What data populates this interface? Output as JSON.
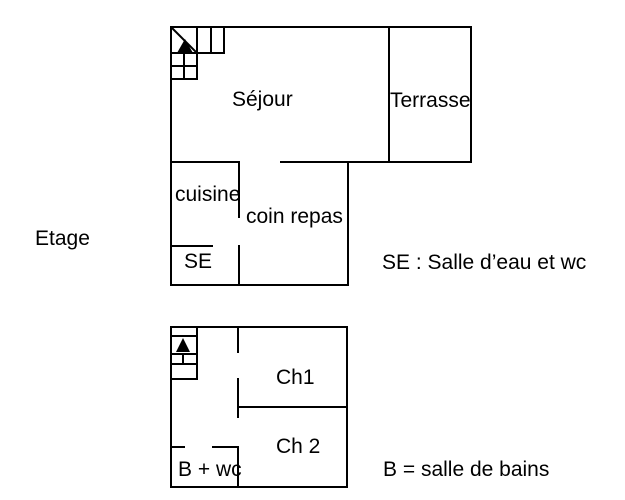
{
  "colors": {
    "background": "#ffffff",
    "line": "#000000",
    "text": "#000000"
  },
  "floor_label": "Etage",
  "upper_plan": {
    "rooms": {
      "sejour": "Séjour",
      "terrasse": "Terrasse",
      "cuisine": "cuisine",
      "coin_repas": "coin repas",
      "se": "SE"
    },
    "legend": "SE : Salle d’eau et wc"
  },
  "lower_plan": {
    "rooms": {
      "ch1": "Ch1",
      "ch2": "Ch 2",
      "b_wc": "B + wc"
    },
    "legend": "B = salle de bains"
  },
  "icons": {
    "upper_stairs": "staircase-with-up-arrow",
    "lower_stairs": "staircase-with-up-arrow"
  }
}
